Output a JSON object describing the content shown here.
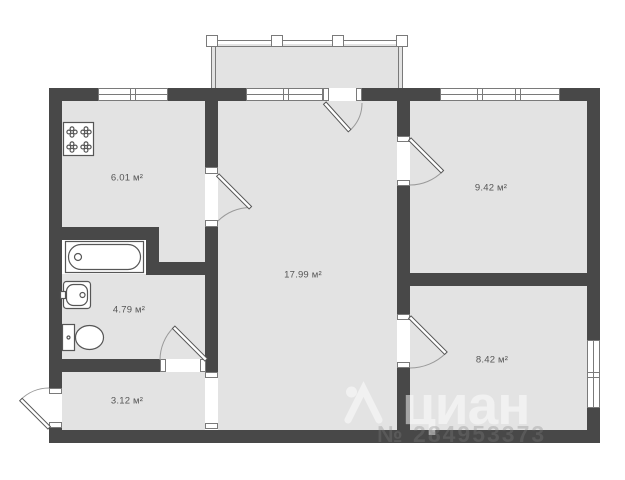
{
  "plan": {
    "type": "apartment-floor-plan",
    "unit": "м²",
    "rooms": [
      {
        "id": "kitchen",
        "area_label": "6.01 м²"
      },
      {
        "id": "room-top-right",
        "area_label": "9.42 м²"
      },
      {
        "id": "living-room",
        "area_label": "17.99 м²"
      },
      {
        "id": "bathroom",
        "area_label": "4.79 м²"
      },
      {
        "id": "room-bottom-right",
        "area_label": "8.42 м²"
      },
      {
        "id": "hallway",
        "area_label": "3.12 м²"
      }
    ],
    "fixtures": [
      {
        "icon": "stove-icon",
        "room": "kitchen"
      },
      {
        "icon": "bathtub-icon",
        "room": "bathroom"
      },
      {
        "icon": "sink-icon",
        "room": "bathroom"
      },
      {
        "icon": "toilet-icon",
        "room": "bathroom"
      },
      {
        "icon": "balcony-railing",
        "room": "balcony"
      }
    ],
    "colors": {
      "wall": "#484848",
      "room_fill": "#e3e3e3",
      "outline": "#7a7a7a",
      "fixture": "#565656",
      "label": "#555555",
      "arc": "#9a9a9a",
      "background": "#ffffff"
    }
  },
  "watermark": {
    "logo": "cian-logo-icon",
    "brand": "циан",
    "listing_id": "№ 284953373"
  }
}
